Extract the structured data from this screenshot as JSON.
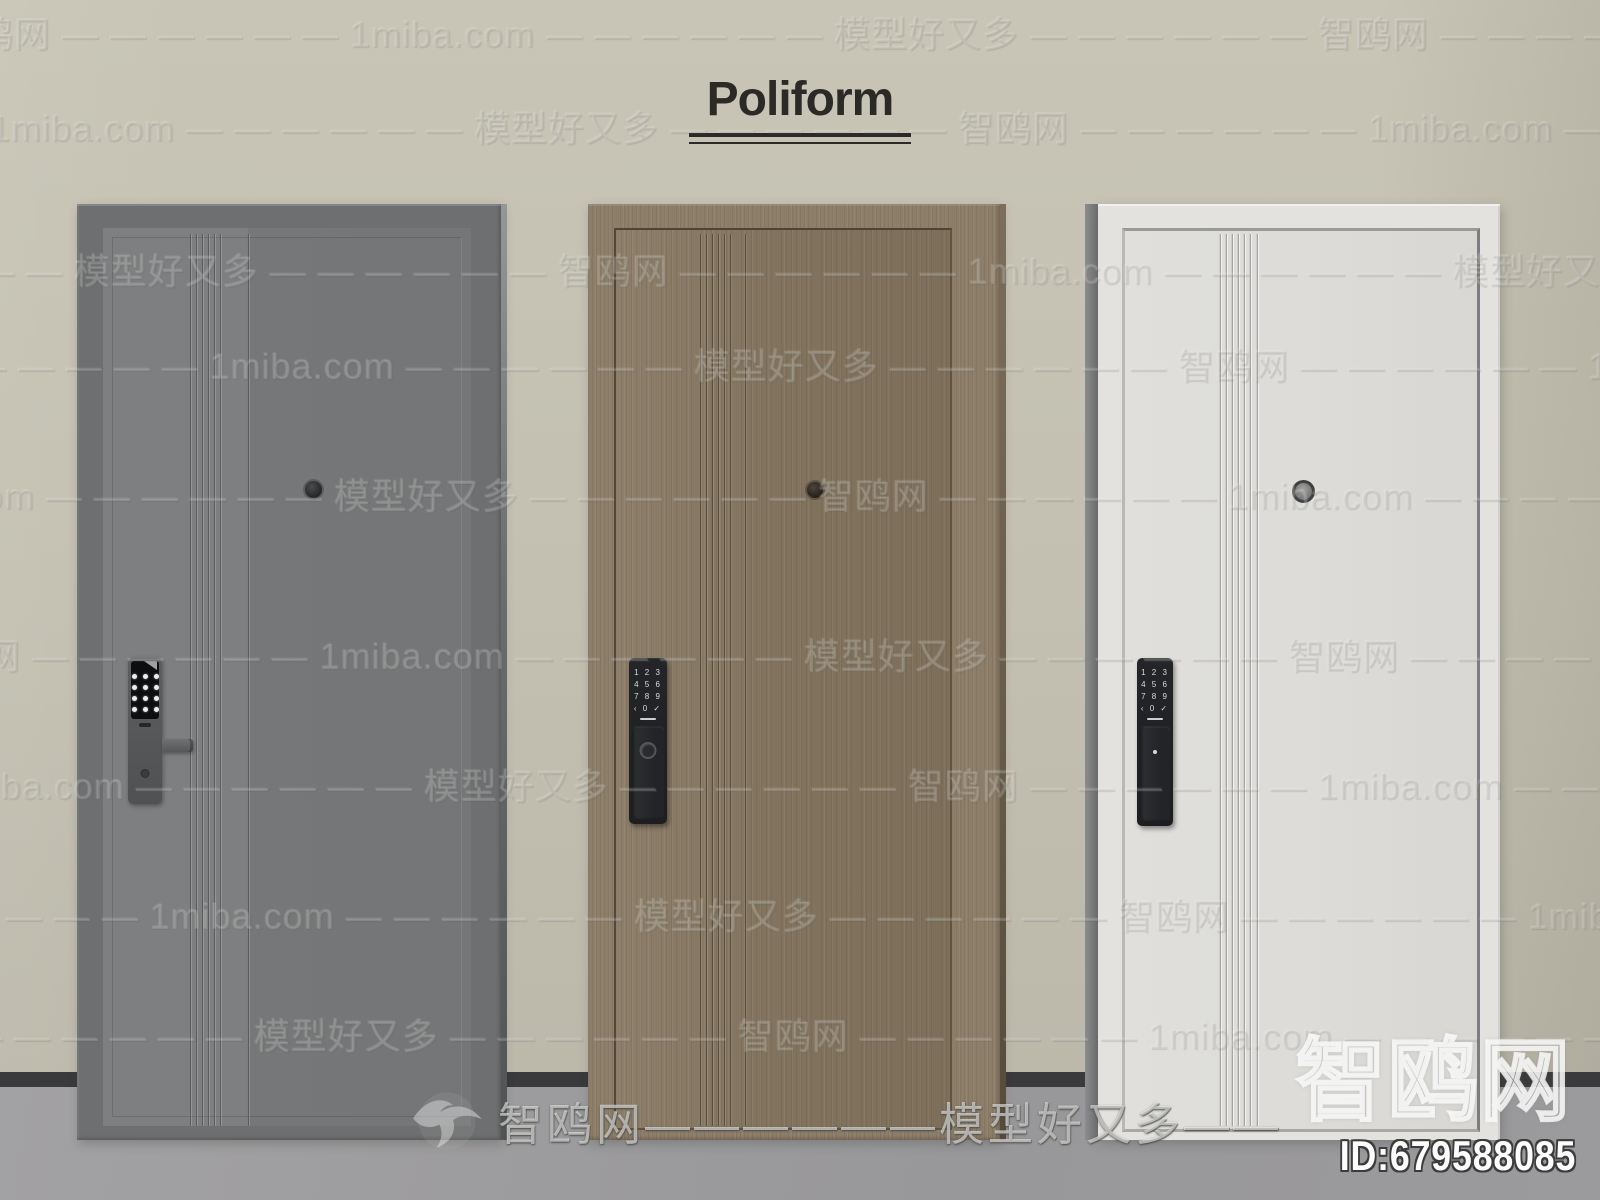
{
  "brand": {
    "title": "Poliform"
  },
  "watermark": {
    "site_name_cn": "智鸥网",
    "site_name_en": "1miba.com",
    "tagline": "模型好又多",
    "tile_unit": "智鸥网 — — — — — — 1miba.com — — — — — — 模型好又多 — — — — — — ",
    "banner_text": "智鸥网——————模型好又多——",
    "corner_text": "智鸥网",
    "model_id": "ID:679588085"
  },
  "lock_keypad": {
    "rows": [
      "1 2 3",
      "4 5 6",
      "7 8 9",
      "‹ 0 ✓"
    ]
  },
  "doors": [
    {
      "name": "grey steel door",
      "lock_type": "keypad smart lock with lever handle",
      "frame_color": "#6d6f70",
      "panel_color": "#7a7c7d"
    },
    {
      "name": "walnut wood door",
      "lock_type": "vertical smart lock with keypad and knob",
      "frame_color": "#8d7e69",
      "panel_color": "#877862"
    },
    {
      "name": "white door",
      "lock_type": "vertical smart lock with keypad and grip",
      "frame_color": "#e3e2df",
      "panel_color": "#deddd9"
    }
  ],
  "palette": {
    "wall": "#c5c2b3",
    "baseboard": "#3a3a3c",
    "floor": "#9c9b9d",
    "title_text": "#2b2a27",
    "lock_body": "#202124"
  }
}
